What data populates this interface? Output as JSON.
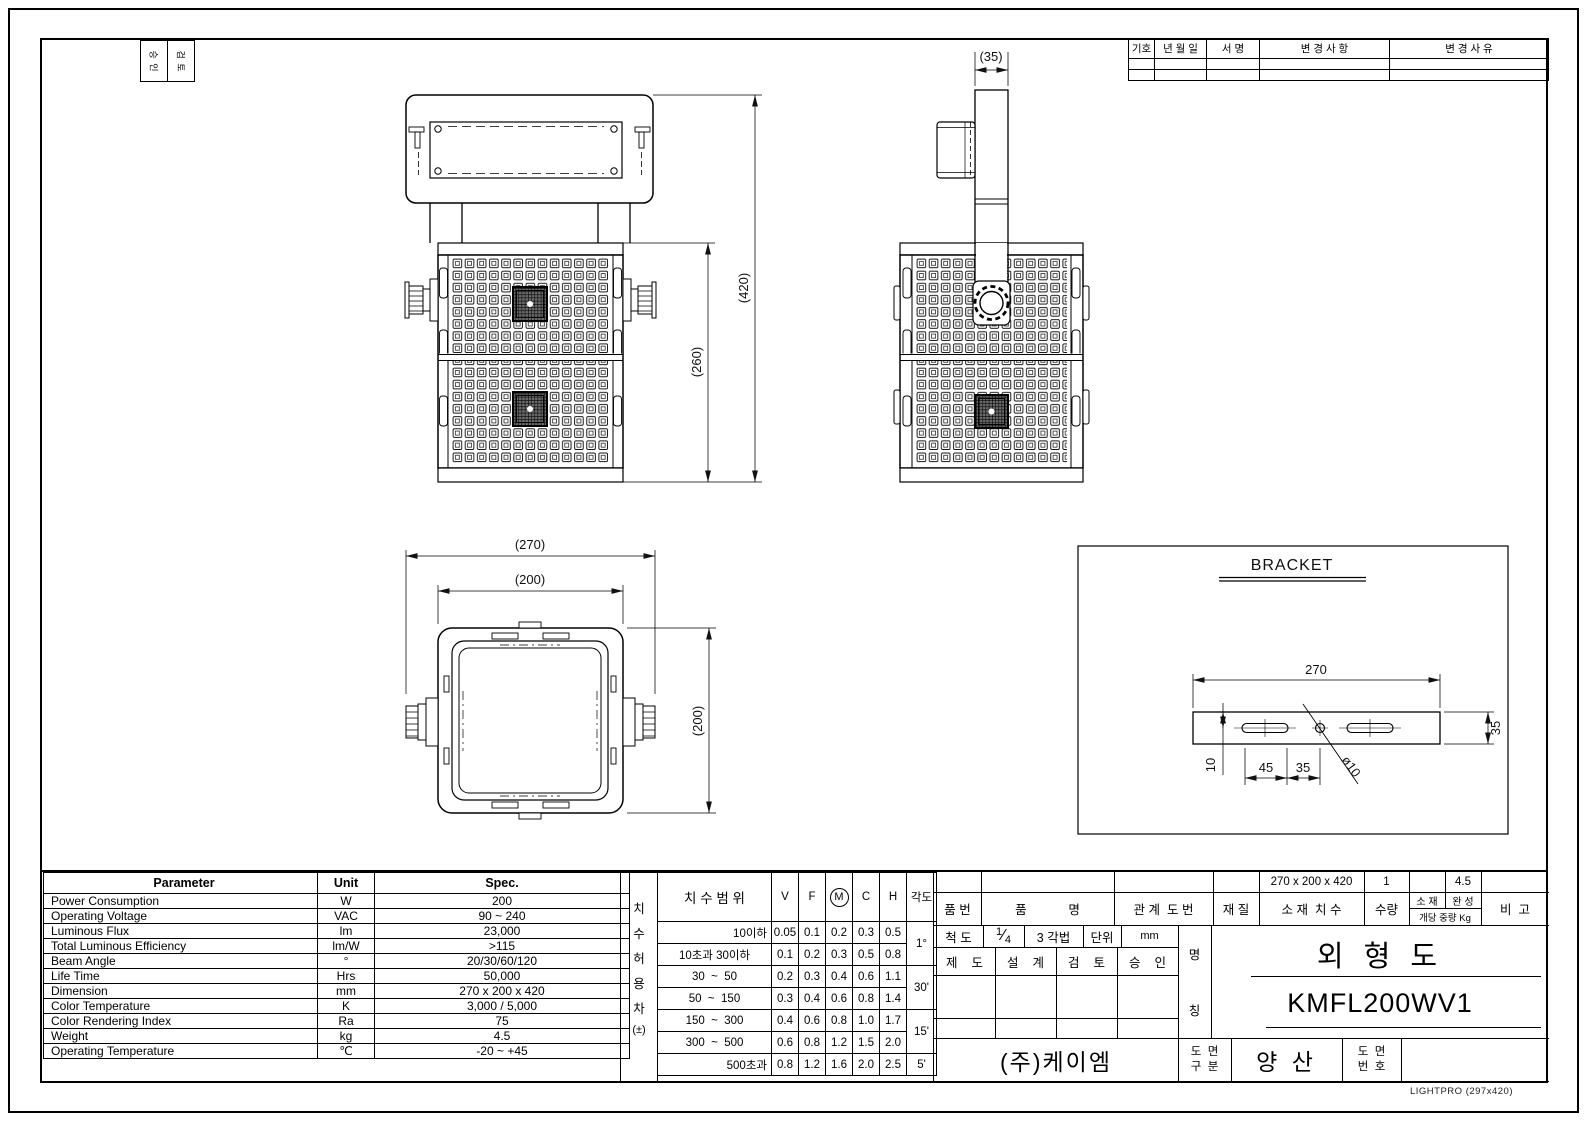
{
  "approval_box": {
    "col1": "승 인",
    "col2": "검 토"
  },
  "revision_table": {
    "headers": [
      "기호",
      "년 월 일",
      "서 명",
      "변 경 사 항",
      "변 경 사 유"
    ]
  },
  "views": {
    "front": {
      "dim_overall_height": "(420)",
      "dim_body_height": "(260)"
    },
    "side": {
      "dim_bracket_width": "(35)"
    },
    "top": {
      "dim_overall_width": "(270)",
      "dim_body_width": "(200)",
      "dim_body_depth": "(200)"
    },
    "bracket_detail": {
      "title": "BRACKET",
      "dim_length": "270",
      "dim_width": "35",
      "dim_hole_offset": "10",
      "dim_slot_length": "45",
      "dim_slot_to_center": "35",
      "dim_hole_diameter": "ø10"
    }
  },
  "parameter_table": {
    "headers": [
      "Parameter",
      "Unit",
      "Spec."
    ],
    "rows": [
      [
        "Power Consumption",
        "W",
        "200"
      ],
      [
        "Operating Voltage",
        "VAC",
        "90 ~ 240"
      ],
      [
        "Luminous Flux",
        "lm",
        "23,000"
      ],
      [
        "Total Luminous Efficiency",
        "lm/W",
        ">115"
      ],
      [
        "Beam Angle",
        "°",
        "20/30/60/120"
      ],
      [
        "Life Time",
        "Hrs",
        "50,000"
      ],
      [
        "Dimension",
        "mm",
        "270 x 200 x 420"
      ],
      [
        "Color Temperature",
        "K",
        "3,000 / 5,000"
      ],
      [
        "Color Rendering Index",
        "Ra",
        "75"
      ],
      [
        "Weight",
        "kg",
        "4.5"
      ],
      [
        "Operating Temperature",
        "℃",
        "-20 ~ +45"
      ]
    ]
  },
  "tolerance_table": {
    "side_label": "치 수 허 용 차",
    "side_label_suffix": "(±)",
    "range_header": "치 수 범 위",
    "grade_headers": [
      "V",
      "F",
      "M",
      "C",
      "H"
    ],
    "angle_header": "각도",
    "rows": [
      {
        "range": "10이하",
        "values": [
          "0.05",
          "0.1",
          "0.2",
          "0.3",
          "0.5"
        ]
      },
      {
        "range": "10초과 30이하",
        "values": [
          "0.1",
          "0.2",
          "0.3",
          "0.5",
          "0.8"
        ]
      },
      {
        "range": "30  ~  50",
        "values": [
          "0.2",
          "0.3",
          "0.4",
          "0.6",
          "1.1"
        ]
      },
      {
        "range": "50  ~  150",
        "values": [
          "0.3",
          "0.4",
          "0.6",
          "0.8",
          "1.4"
        ]
      },
      {
        "range": "150  ~  300",
        "values": [
          "0.4",
          "0.6",
          "0.8",
          "1.0",
          "1.7"
        ]
      },
      {
        "range": "300  ~  500",
        "values": [
          "0.6",
          "0.8",
          "1.2",
          "1.5",
          "2.0"
        ]
      },
      {
        "range": "500초과",
        "values": [
          "0.8",
          "1.2",
          "1.6",
          "2.0",
          "2.5"
        ]
      }
    ],
    "angle_values": [
      "1°",
      "30'",
      "15'",
      "5'"
    ]
  },
  "title_block": {
    "col_headers": {
      "part_no": "품 번",
      "part_name": "품            명",
      "related_dwg": "관 계  도 번",
      "material": "재 질",
      "stock_size": "소 재  치 수",
      "qty": "수량",
      "wt_stock": "소 재",
      "wt_finished": "완 성",
      "wt_unit": "개당 중량 Kg",
      "remark": "비  고"
    },
    "values": {
      "stock_size": "270 x 200 x 420",
      "qty": "1",
      "wt_stock": "",
      "wt_finished": "4.5",
      "remark": ""
    },
    "scale_label": "척 도",
    "scale_num": "1",
    "scale_slash": "⁄",
    "scale_den": "4",
    "projection": "3 각법",
    "unit_label": "단위",
    "unit_value": "mm",
    "sign_headers": [
      "제    도",
      "설    계",
      "검    토",
      "승    인"
    ],
    "name_label_top": "명",
    "name_label_bottom": "칭",
    "drawing_title": "외 형 도",
    "model_no": "KMFL200WV1",
    "company": "(주)케이엠",
    "class_label_l1": "도  면",
    "class_label_l2": "구  분",
    "class_value": "양 산",
    "no_label_l1": "도  면",
    "no_label_l2": "번  호",
    "no_value": ""
  },
  "footer": {
    "stamp": "LIGHTPRO (297x420)"
  }
}
